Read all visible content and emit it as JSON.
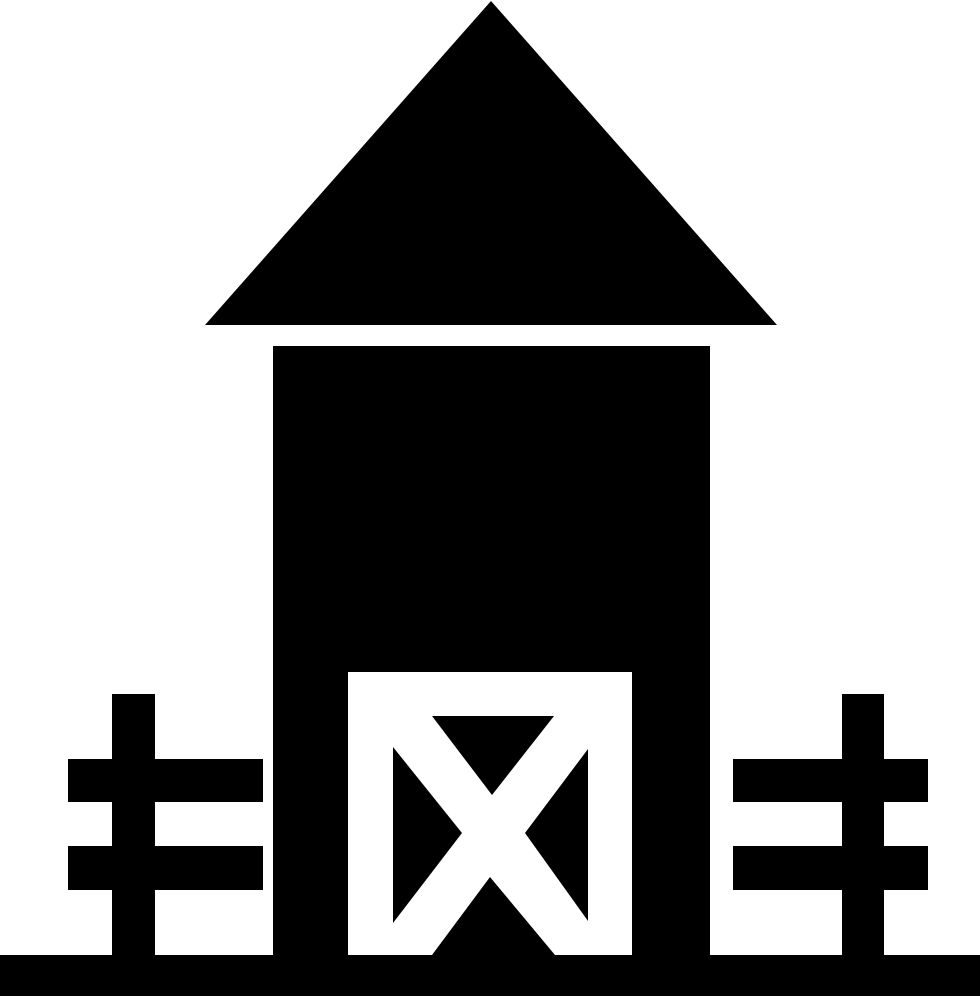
{
  "meta": {
    "title": "Barn glyph icon",
    "background_color": "#ffffff",
    "foreground_color": "#000000",
    "canvas_width": 980,
    "canvas_height": 1000
  },
  "icon": {
    "name": "barn-icon",
    "description": "Solid black barn pictogram: triangular roof, tall rectangular body, white doorway with black crossbuck (X) door panel, a two-rail fence on each side, and a full-width ground bar.",
    "shapes": {
      "roof": "M491,1 L777,325 L205,325 Z",
      "body": "M273,346 H710 V996 H273 Z",
      "door_opening": "M348,672 H632 V955 H348 Z",
      "door_panel_triangle_top": "M432,716 L554,716 L492,795 Z",
      "door_panel_triangle_left": "M393,747 L462,833 L393,923 Z",
      "door_panel_triangle_right": "M588,749 L525,833 L588,921 Z",
      "door_panel_triangle_bottom": "M490,877 L555,955 L432,955 Z",
      "ground_bar": "M0,955 H980 V996 H0 Z",
      "left_fence_post": "M112,694 H155 V996 H112 Z",
      "left_fence_rail_top": "M68,759 H263 V802 H68 Z",
      "left_fence_rail_bottom": "M68,846 H263 V890 H68 Z",
      "right_fence_post": "M842,694 H884 V996 H842 Z",
      "right_fence_rail_top": "M733,759 H928 V802 H733 Z",
      "right_fence_rail_bottom": "M733,846 H928 V890 H733 Z"
    }
  }
}
